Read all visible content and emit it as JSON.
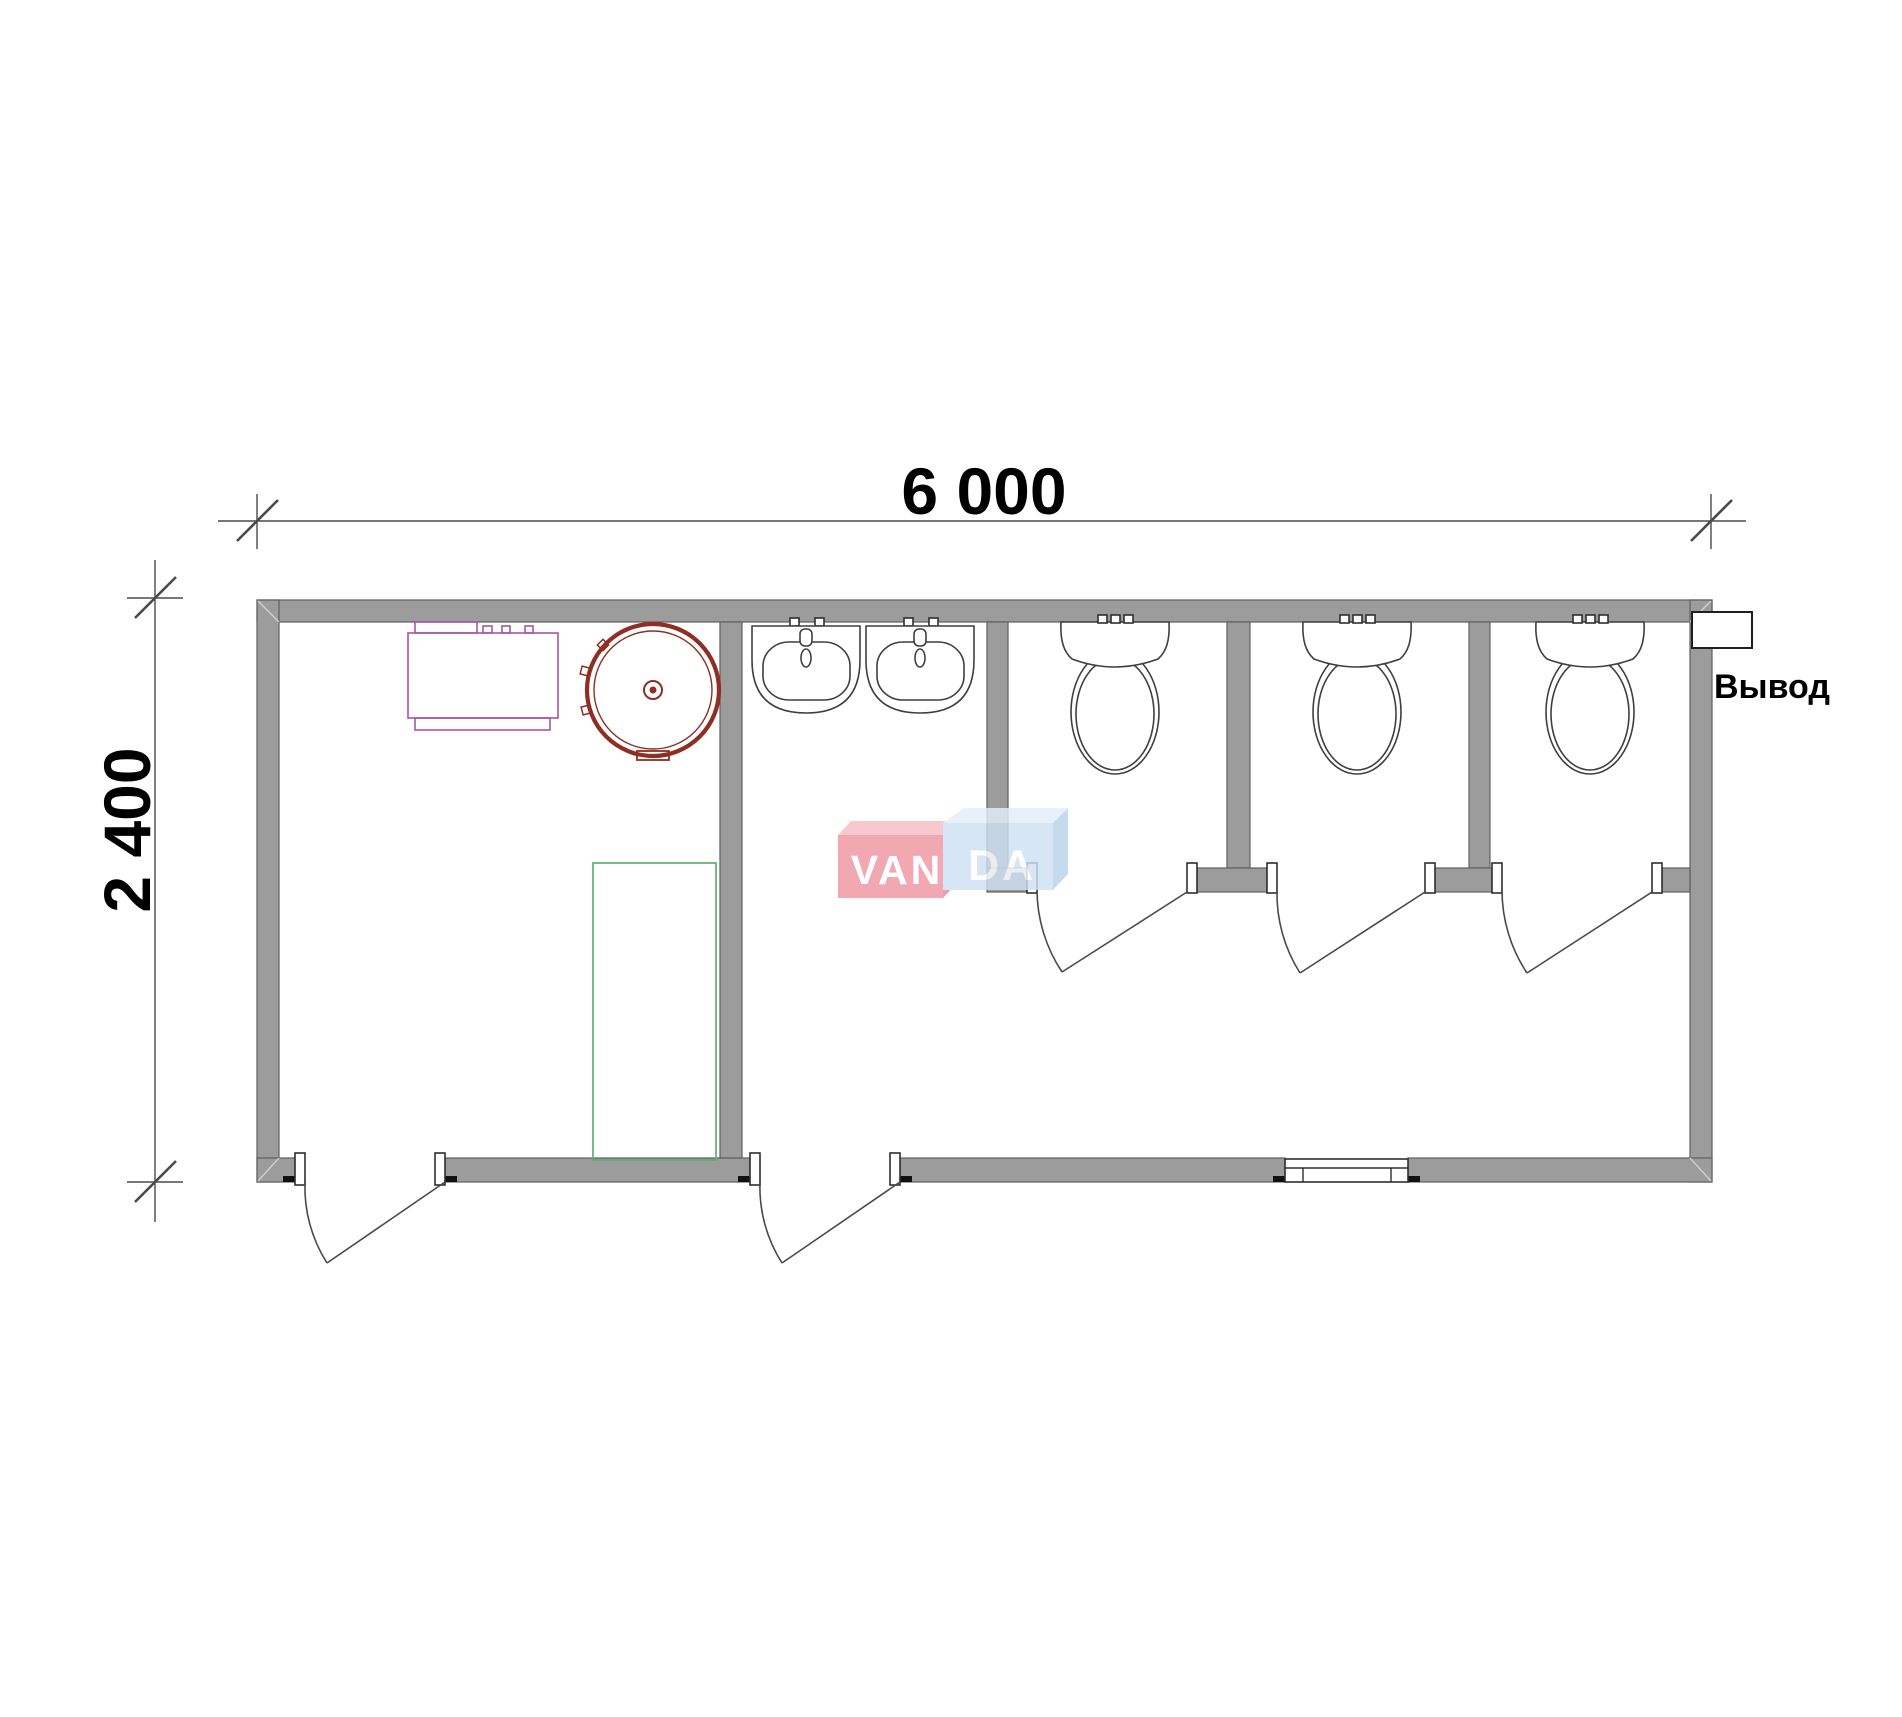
{
  "dimensions": {
    "width_label": "6 000",
    "height_label": "2 400"
  },
  "outlet": {
    "label": "Вывод"
  },
  "watermark": {
    "left_text": "VAN",
    "right_text": "DA"
  },
  "colors": {
    "wall_fill": "#9c9c9c",
    "wall_edge": "#5f5f5f",
    "fixture_line": "#3f3f3f",
    "boiler_purple": "#a757a7",
    "tank_red": "#8e2e24",
    "shower_green": "#5fae6e",
    "watermark_pink": "#ef96a3",
    "watermark_pink_top": "#f6bcc4",
    "watermark_pink_side": "#e4899a",
    "watermark_blue": "#cfe1f2",
    "watermark_blue_top": "#e4eef9",
    "watermark_blue_side": "#b9d2e8",
    "dimension_text": "#000000"
  }
}
